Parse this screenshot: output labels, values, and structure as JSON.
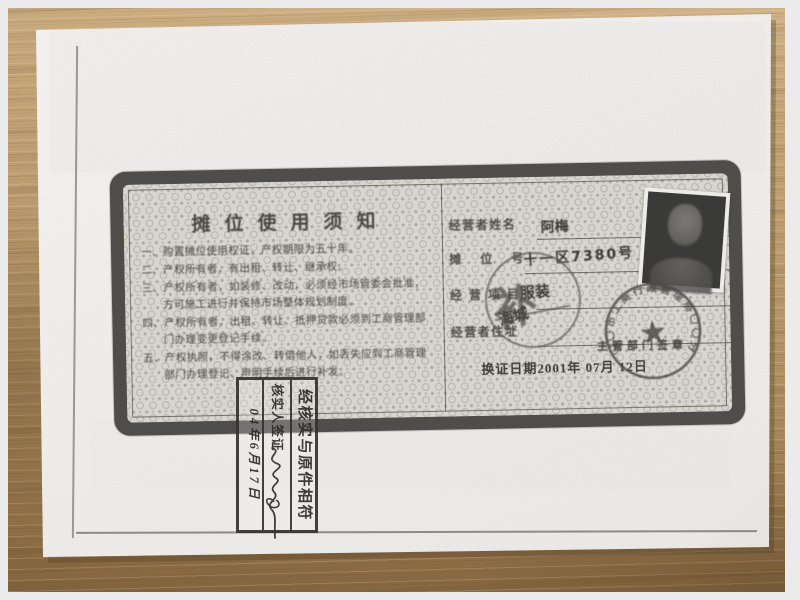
{
  "colors": {
    "frame_background": "#ebebeb",
    "wood": "#b5976a",
    "paper": "#f1f0ee",
    "toner_ink": "#49463f",
    "stamp_ink": "#4a4742"
  },
  "certificate": {
    "notice": {
      "title": "摊位使用须知",
      "items": [
        "一、购置摊位使用权证，产权期限为五十年。",
        "二、产权所有者，有出租、转让、继承权。",
        "三、产权所有者，如装修、改动，必须经市场管委会批准，方可施工进行并保持市场整体规划制度。",
        "四、产权所有者，出租、转让、抵押贷款必须到工商管理部门办理变更登记手续。",
        "五、产权执照，不得涂改、转借他人，如丢失应到工商管理部门办理登记、声明手续后进行补发。"
      ]
    },
    "fields": {
      "name_label": "经营者姓名",
      "name_value": "阿梅",
      "stall_label": "摊位号",
      "stall_value": "十一区7380号",
      "business_label": "经营项目",
      "business_value": "服装",
      "address_label": "经营者住址",
      "address_value": "海城"
    },
    "seal_line": "主管部门签章",
    "renewal_date": "换证日期2001年 07月 12日",
    "official_stamp": {
      "ring_text": "〇〇市工商行政管理局〇〇分局",
      "star": "★"
    },
    "market_stamp": {
      "glyph": "补",
      "glyph2": "巳"
    }
  },
  "verification_stamp": {
    "line1": "经核实与原件相符",
    "line2": "核实人签证",
    "line3": "04年6月17日"
  }
}
